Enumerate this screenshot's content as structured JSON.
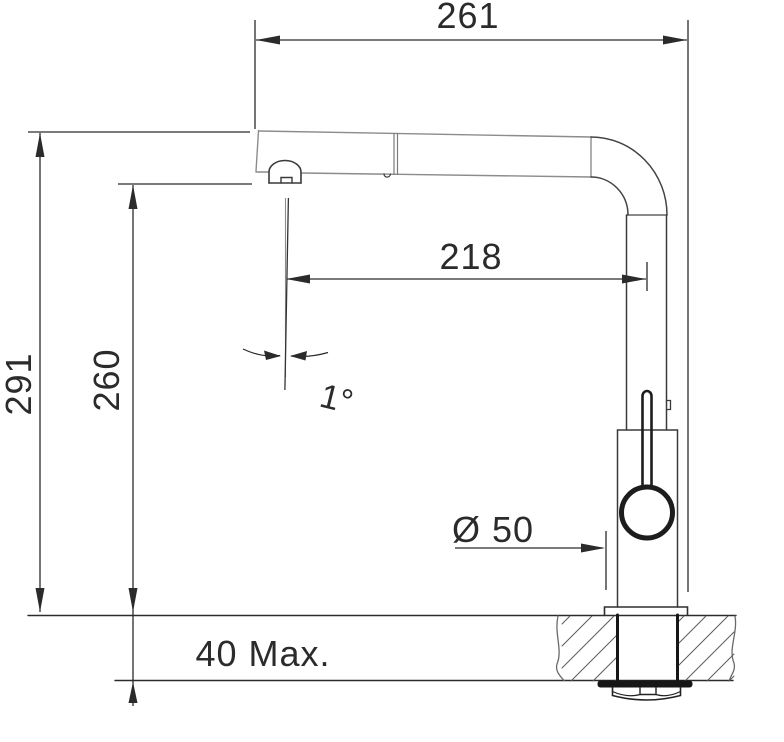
{
  "labels": {
    "total_width": "261",
    "total_height": "291",
    "outlet_height": "260",
    "spout_reach": "218",
    "spout_angle": "1°",
    "base_diameter": "Ø 50",
    "max_counter_thickness": "40 Max."
  },
  "colors": {
    "outline": "#333333",
    "tube_outline": "#8c8c8c",
    "dimension_line": "#2b2b2b",
    "hatch": "#5a5a5a",
    "solid_fill": "#161616",
    "background": "#ffffff"
  }
}
